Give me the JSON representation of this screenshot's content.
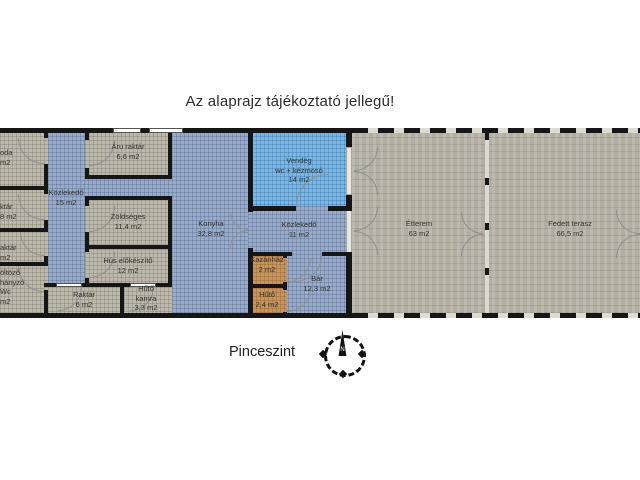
{
  "title": "Az alaprajz tájékoztató jellegű!",
  "level_label": "Pinceszint",
  "compass": {
    "north_label": "N"
  },
  "colors": {
    "wall": "#161616",
    "room_gray": "#bcb8ac",
    "room_blue": "#9aabca",
    "room_lightblue": "#7cb6e2",
    "room_tan": "#c6955f",
    "terrace": "#b3aea2",
    "background": "#ffffff"
  },
  "rooms": {
    "iroda_cut": {
      "line1": "oda",
      "line2": "m2"
    },
    "raktar_cut1": {
      "line1": "ktár",
      "line2": "8 m2"
    },
    "raktar_cut2": {
      "line1": "aktár",
      "line2": "m2"
    },
    "oltozo_cut": {
      "line1": "öltöző",
      "line2": "hányzó",
      "line3": "Wc",
      "line4": "m2"
    },
    "kozlekedo15": {
      "name": "Közlekedő",
      "area": "15 m2"
    },
    "aru_raktar": {
      "name": "Áru raktár",
      "area": "6,6 m2"
    },
    "zoldseges": {
      "name": "Zöldséges",
      "area": "11,4 m2"
    },
    "hus_elokeszito": {
      "name": "Hús előkészítő",
      "area": "12 m2"
    },
    "raktar6": {
      "name": "Raktár",
      "area": "6 m2"
    },
    "huto_kamra": {
      "name": "Hűtő",
      "name2": "kamra",
      "area": "3,3 m2"
    },
    "konyha": {
      "name": "Konyha",
      "area": "32,8 m2"
    },
    "vendeg_wc": {
      "name": "Vendég",
      "name2": "wc + kézmosó",
      "area": "14 m2"
    },
    "kozlekedo11": {
      "name": "Közlekedő",
      "area": "11 m2"
    },
    "kazanhaz": {
      "name": "Kazánház",
      "area": "2 m2"
    },
    "huto": {
      "name": "Hűtő",
      "area": "2,4 m2"
    },
    "bar": {
      "name": "Bár",
      "area": "12,3 m2"
    },
    "etterem": {
      "name": "Étterem",
      "area": "63 m2"
    },
    "fedett_terasz": {
      "name": "Fedett terasz",
      "area": "66,5 m2"
    }
  }
}
